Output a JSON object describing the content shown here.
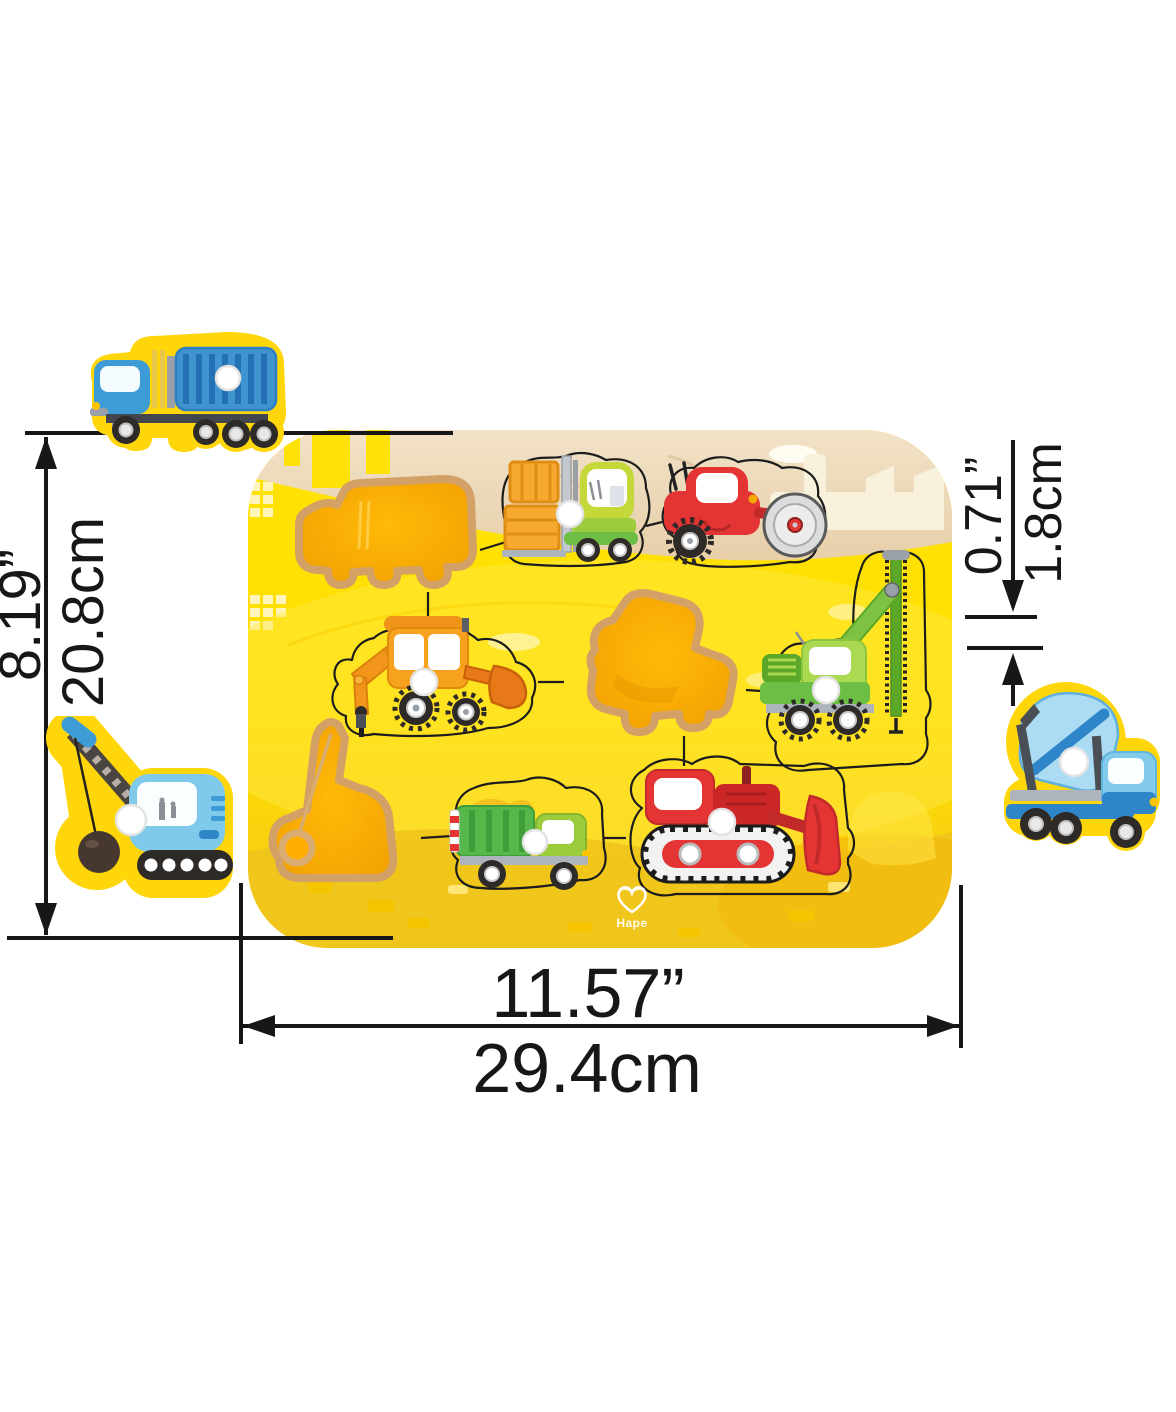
{
  "scene": {
    "type": "product-photo",
    "background": "#ffffff"
  },
  "brand": {
    "logo_text": "Hape"
  },
  "dimensions": {
    "height": {
      "inches": "8.19”",
      "cm": "20.8cm"
    },
    "width": {
      "inches": "11.57”",
      "cm": "29.4cm"
    },
    "thickness": {
      "inches": "0.71”",
      "cm": "1.8cm"
    }
  },
  "puzzle": {
    "board": {
      "description": "wooden construction-site peg puzzle board",
      "colors": {
        "board_yellow": "#FFDF00",
        "board_shade": "#F0C41D",
        "wood_band": "#EDD8BA",
        "hole_fill": "#FFAE00",
        "hole_edge": "#D3A066",
        "piece_rim_yellow": "#FFD60A",
        "outline_black": "#1c1c1c",
        "dimension_line": "#171717"
      }
    },
    "pieces_on_board": [
      {
        "id": "forklift",
        "color": "lime-green"
      },
      {
        "id": "road-roller",
        "color": "red"
      },
      {
        "id": "backhoe-loader",
        "color": "orange"
      },
      {
        "id": "pile-driver-crane-truck",
        "color": "green"
      },
      {
        "id": "dump-truck",
        "color": "green"
      },
      {
        "id": "bulldozer",
        "color": "red"
      }
    ],
    "empty_holes": [
      {
        "id": "container-truck-hole"
      },
      {
        "id": "cement-mixer-hole"
      },
      {
        "id": "wrecking-crane-hole"
      }
    ],
    "removed_pieces": [
      {
        "id": "container-truck",
        "color": "blue"
      },
      {
        "id": "wrecking-crane",
        "color": "blue"
      },
      {
        "id": "cement-mixer",
        "color": "blue"
      }
    ]
  }
}
